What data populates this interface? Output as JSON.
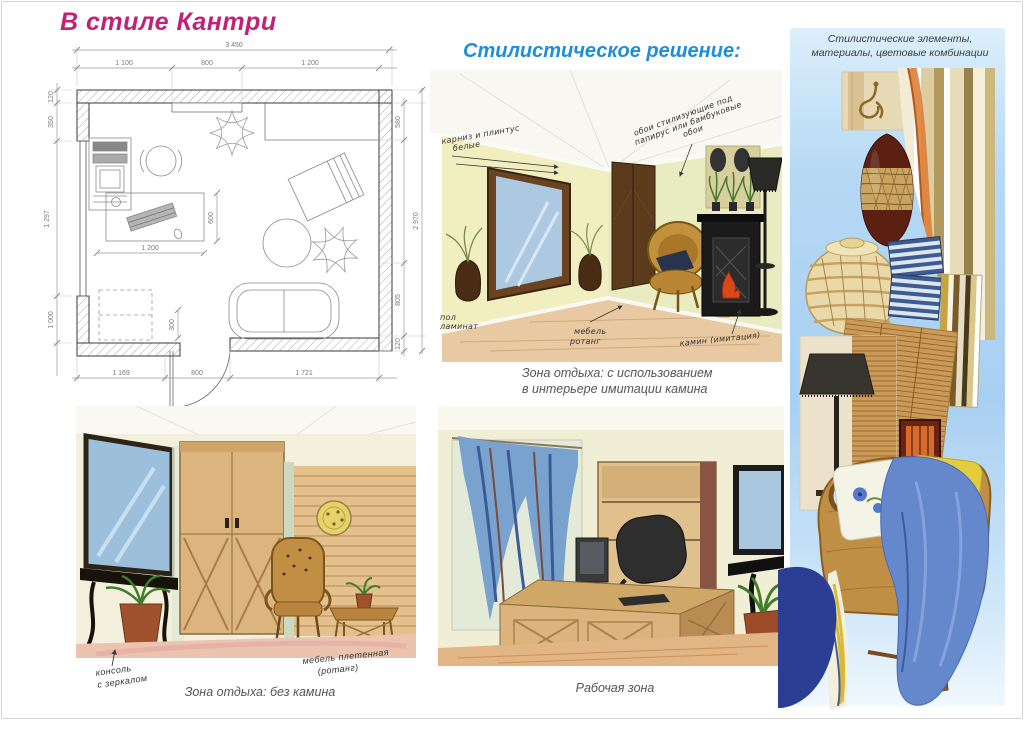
{
  "page": {
    "title": "В стиле Кантри",
    "subtitle": "Стилистическое решение:",
    "palette_caption_1": "Стилистические элементы,",
    "palette_caption_2": "материалы, цветовые комбинации",
    "accent_pink": "#c32078",
    "accent_blue": "#1e8ed8",
    "panel_blue": "#aed4f2"
  },
  "floor_plan": {
    "dims": {
      "total_w": "3 450",
      "top_a": "1 100",
      "top_b": "800",
      "top_c": "1 200",
      "left_a": "120",
      "left_b": "350",
      "left_c": "1 297",
      "left_d": "1 000",
      "bottom_a": "1 169",
      "bottom_b": "800",
      "bottom_c": "1 721",
      "right_a": "580",
      "right_b": "2 970",
      "right_c": "805",
      "right_d": "120",
      "inner_a": "600",
      "inner_b": "1 200",
      "inner_c": "300"
    }
  },
  "sketch_fireplace": {
    "note_cornice_1": "карниз и плинтус",
    "note_cornice_2": "белые",
    "note_wallpaper_1": "обои стилизующие под",
    "note_wallpaper_2": "папирус или бамбуковые",
    "note_wallpaper_3": "обои",
    "note_floor_1": "пол",
    "note_floor_2": "ламинат",
    "note_furniture_1": "мебель",
    "note_furniture_2": "ротанг",
    "note_fireplace": "камин (имитация)",
    "caption_1": "Зона отдыха: с использованием",
    "caption_2": "в интерьере  имитации камина"
  },
  "sketch_no_fireplace": {
    "note_console_1": "консоль",
    "note_console_2": "с зеркалом",
    "note_furniture_1": "мебель плетенная",
    "note_furniture_2": "(ротанг)",
    "caption": "Зона отдыха: без камина"
  },
  "sketch_work": {
    "caption": "Рабочая зона"
  }
}
